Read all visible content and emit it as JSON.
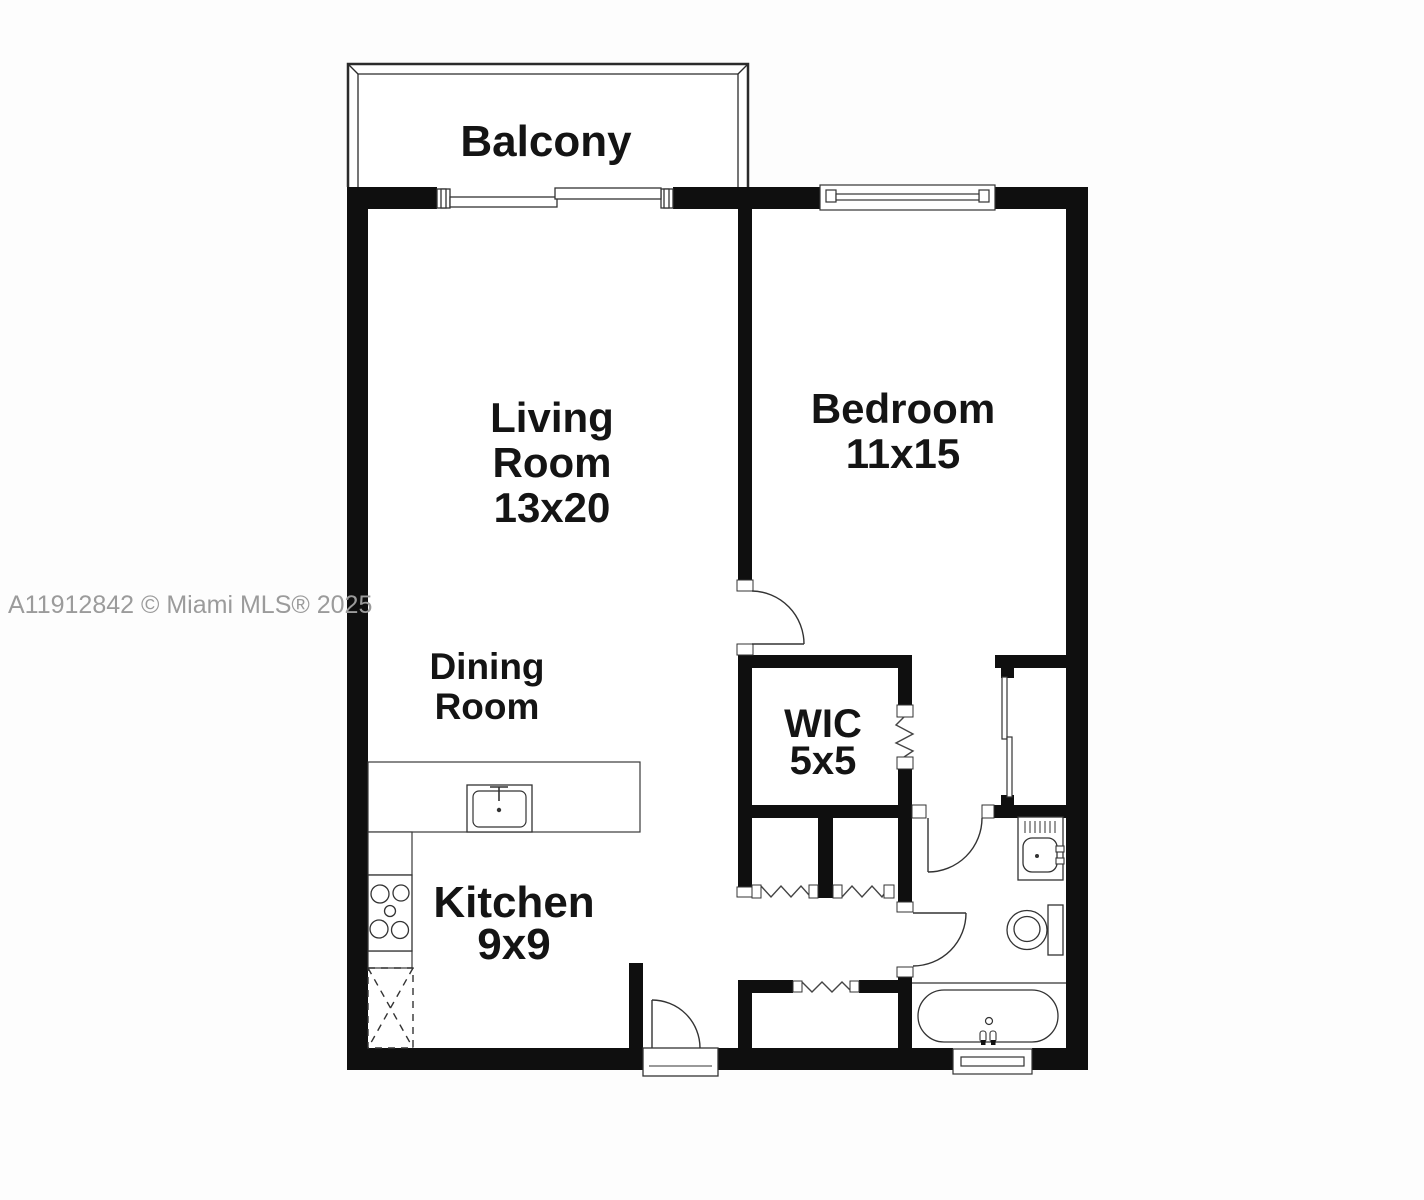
{
  "watermark": "A11912842 © Miami MLS® 2025",
  "colors": {
    "wall": "#0f0f0f",
    "line": "#333333",
    "background": "#fdfdfd",
    "floor": "#ffffff",
    "watermark_gray": "#9b9b9b"
  },
  "rooms": {
    "balcony": {
      "name": "Balcony"
    },
    "living": {
      "line1": "Living",
      "line2": "Room",
      "dims": "13x20"
    },
    "bedroom": {
      "name": "Bedroom",
      "dims": "11x15"
    },
    "dining": {
      "line1": "Dining",
      "line2": "Room"
    },
    "wic": {
      "name": "WIC",
      "dims": "5x5"
    },
    "kitchen": {
      "name": "Kitchen",
      "dims": "9x9"
    }
  },
  "fixtures": {
    "kitchen_sink": "kitchen sink",
    "stove": "4-burner stove",
    "future_appliance": "dashed appliance space",
    "vanity_sink": "bathroom vanity sink",
    "toilet": "toilet",
    "bathtub": "bathtub"
  },
  "openings": {
    "balcony_slider": "sliding glass door",
    "bedroom_window": "window",
    "bathroom_window": "window",
    "entry_door": "entry door",
    "bedroom_door": "bedroom door",
    "bathroom_doors": "bathroom doors",
    "closet_doors": "accordion and sliding closet doors"
  }
}
